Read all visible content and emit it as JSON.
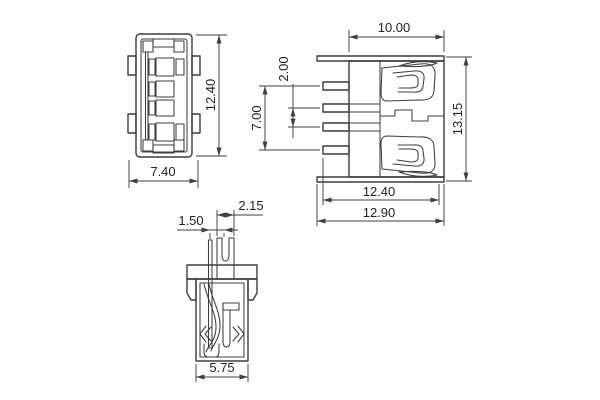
{
  "colors": {
    "background": "#ffffff",
    "object_line": "#3d3d3d",
    "dimension_line": "#3f3f3f",
    "text": "#1f1f1f"
  },
  "dims": {
    "top_view_width": "7.40",
    "top_view_height": "12.40",
    "front_shell_width": "10.00",
    "front_pin_pitch": "2.00",
    "front_pin_span": "7.00",
    "front_height": "13.15",
    "front_body_width": "12.40",
    "front_overall_width": "12.90",
    "side_post_width": "2.15",
    "side_contact_offset": "1.50",
    "side_body_width": "5.75"
  }
}
